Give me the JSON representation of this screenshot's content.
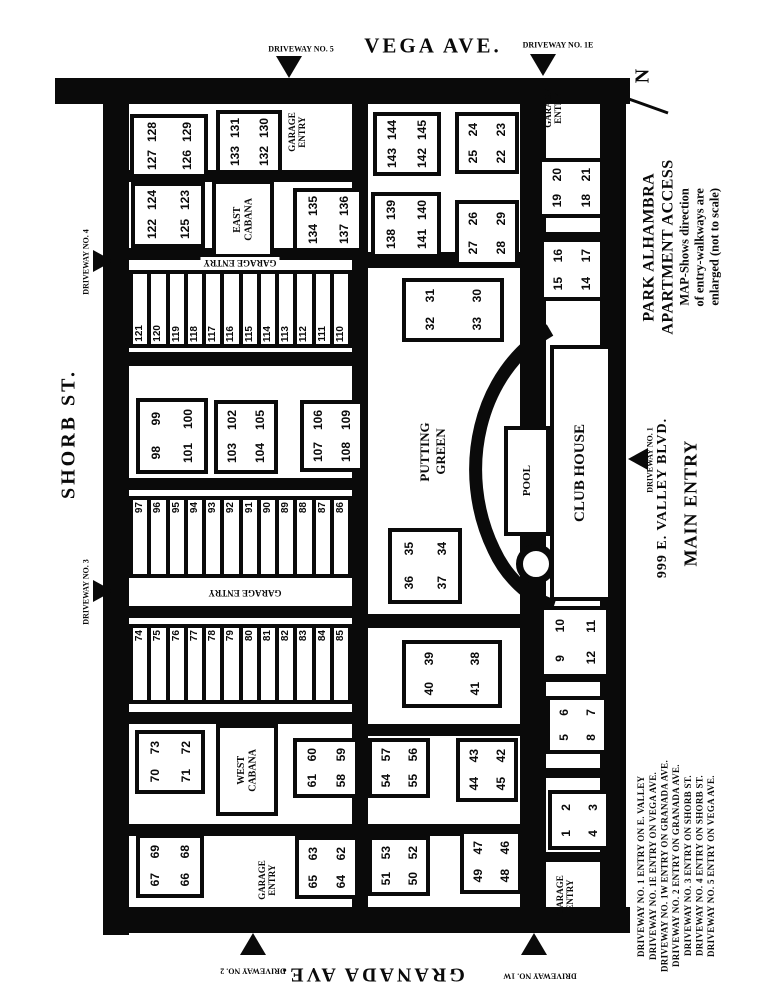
{
  "map": {
    "ink": "#0a0a0a",
    "bg": "#ffffff",
    "streets": {
      "top": "VEGA AVE.",
      "bottom": "GRANADA AVE.",
      "left": "SHORB ST.",
      "right_address": "999 E. VALLEY BLVD.",
      "right_entry": "MAIN ENTRY"
    },
    "north_label": "N",
    "title": {
      "line1": "PARK ALHAMBRA",
      "line2": "APARTMENT ACCESS",
      "line3": "MAP-Shows direction",
      "line4": "of entry-walkways are",
      "line5": "enlarged (not to scale)"
    },
    "legend": [
      "DRIVEWAY NO. 1 ENTRY ON E. VALLEY",
      "DRIVEWAY NO. 1E ENTRY ON VEGA AVE.",
      "DRIVEWAY NO. 1W ENTRY ON GRANADA AVE.",
      "DRIVEWAY NO. 2 ENTRY ON GRANADA AVE.",
      "DRIVEWAY NO. 3 ENTRY ON SHORB ST.",
      "DRIVEWAY NO. 4 ENTRY ON SHORB ST.",
      "DRIVEWAY NO. 5 ENTRY ON VEGA AVE."
    ],
    "roads": [
      {
        "id": "road-vega-top",
        "x": 55,
        "y": 78,
        "w": 575,
        "h": 26
      },
      {
        "id": "road-shorb-left",
        "x": 103,
        "y": 78,
        "w": 26,
        "h": 857
      },
      {
        "id": "road-granada-bottom",
        "x": 103,
        "y": 907,
        "w": 527,
        "h": 26
      },
      {
        "id": "road-valley-right",
        "x": 600,
        "y": 78,
        "w": 26,
        "h": 855
      },
      {
        "id": "road-center-west",
        "x": 352,
        "y": 96,
        "w": 16,
        "h": 812
      },
      {
        "id": "road-center-east",
        "x": 520,
        "y": 96,
        "w": 26,
        "h": 812
      },
      {
        "id": "walk-row1",
        "x": 129,
        "y": 170,
        "w": 223,
        "h": 12
      },
      {
        "id": "walk-aisle1",
        "x": 129,
        "y": 248,
        "w": 223,
        "h": 12
      },
      {
        "id": "walk-row2",
        "x": 129,
        "y": 352,
        "w": 223,
        "h": 14
      },
      {
        "id": "walk-row3",
        "x": 129,
        "y": 478,
        "w": 223,
        "h": 12
      },
      {
        "id": "walk-row4",
        "x": 129,
        "y": 606,
        "w": 223,
        "h": 12
      },
      {
        "id": "walk-row5",
        "x": 129,
        "y": 712,
        "w": 223,
        "h": 12
      },
      {
        "id": "walk-row6",
        "x": 129,
        "y": 824,
        "w": 223,
        "h": 12
      },
      {
        "id": "walk-mid1",
        "x": 368,
        "y": 252,
        "w": 152,
        "h": 16
      },
      {
        "id": "walk-mid2",
        "x": 368,
        "y": 614,
        "w": 152,
        "h": 14
      },
      {
        "id": "walk-mid3",
        "x": 368,
        "y": 724,
        "w": 152,
        "h": 12
      },
      {
        "id": "walk-mid4",
        "x": 368,
        "y": 824,
        "w": 152,
        "h": 12
      },
      {
        "id": "walk-east1",
        "x": 546,
        "y": 180,
        "w": 58,
        "h": 10
      },
      {
        "id": "walk-east2",
        "x": 546,
        "y": 232,
        "w": 58,
        "h": 12
      },
      {
        "id": "walk-east3",
        "x": 546,
        "y": 672,
        "w": 58,
        "h": 10
      },
      {
        "id": "walk-east4",
        "x": 546,
        "y": 768,
        "w": 58,
        "h": 10
      },
      {
        "id": "walk-east5",
        "x": 546,
        "y": 852,
        "w": 58,
        "h": 10
      }
    ],
    "buildings": [
      {
        "id": "building-126-129",
        "x": 130,
        "y": 114,
        "w": 70,
        "h": 56,
        "units": [
          [
            "128",
            "129"
          ],
          [
            "127",
            "126"
          ]
        ]
      },
      {
        "id": "building-130-133",
        "x": 216,
        "y": 110,
        "w": 58,
        "h": 56,
        "units": [
          [
            "131",
            "130"
          ],
          [
            "133",
            "132"
          ]
        ]
      },
      {
        "id": "building-122-125",
        "x": 131,
        "y": 182,
        "w": 66,
        "h": 58,
        "units": [
          [
            "124",
            "123"
          ],
          [
            "122",
            "125"
          ]
        ]
      },
      {
        "id": "building-134-137",
        "x": 293,
        "y": 188,
        "w": 62,
        "h": 56,
        "units": [
          [
            "135",
            "136"
          ],
          [
            "134",
            "137"
          ]
        ]
      },
      {
        "id": "building-142-145",
        "x": 373,
        "y": 112,
        "w": 60,
        "h": 56,
        "units": [
          [
            "144",
            "145"
          ],
          [
            "143",
            "142"
          ]
        ]
      },
      {
        "id": "building-22-25",
        "x": 455,
        "y": 112,
        "w": 56,
        "h": 54,
        "units": [
          [
            "24",
            "23"
          ],
          [
            "25",
            "22"
          ]
        ]
      },
      {
        "id": "building-138-141",
        "x": 371,
        "y": 192,
        "w": 62,
        "h": 58,
        "units": [
          [
            "139",
            "140"
          ],
          [
            "138",
            "141"
          ]
        ]
      },
      {
        "id": "building-26-29",
        "x": 455,
        "y": 200,
        "w": 56,
        "h": 58,
        "units": [
          [
            "26",
            "29"
          ],
          [
            "27",
            "28"
          ]
        ]
      },
      {
        "id": "building-18-21",
        "x": 538,
        "y": 158,
        "w": 58,
        "h": 52,
        "units": [
          [
            "20",
            "21"
          ],
          [
            "19",
            "18"
          ]
        ]
      },
      {
        "id": "building-14-17",
        "x": 540,
        "y": 238,
        "w": 56,
        "h": 55,
        "units": [
          [
            "16",
            "17"
          ],
          [
            "15",
            "14"
          ]
        ]
      },
      {
        "id": "building-30-33",
        "x": 402,
        "y": 278,
        "w": 94,
        "h": 56,
        "units": [
          [
            "31",
            "30"
          ],
          [
            "32",
            "33"
          ]
        ]
      },
      {
        "id": "building-98-101",
        "x": 136,
        "y": 398,
        "w": 64,
        "h": 68,
        "units": [
          [
            "99",
            "100"
          ],
          [
            "98",
            "101"
          ]
        ]
      },
      {
        "id": "building-102-105",
        "x": 214,
        "y": 400,
        "w": 56,
        "h": 66,
        "units": [
          [
            "102",
            "105"
          ],
          [
            "103",
            "104"
          ]
        ]
      },
      {
        "id": "building-106-109",
        "x": 300,
        "y": 400,
        "w": 56,
        "h": 64,
        "units": [
          [
            "106",
            "109"
          ],
          [
            "107",
            "108"
          ]
        ]
      },
      {
        "id": "building-34-37",
        "x": 388,
        "y": 528,
        "w": 66,
        "h": 68,
        "units": [
          [
            "35",
            "34"
          ],
          [
            "36",
            "37"
          ]
        ]
      },
      {
        "id": "building-38-41",
        "x": 402,
        "y": 640,
        "w": 92,
        "h": 60,
        "units": [
          [
            "39",
            "38"
          ],
          [
            "40",
            "41"
          ]
        ]
      },
      {
        "id": "building-9-12",
        "x": 540,
        "y": 606,
        "w": 62,
        "h": 64,
        "units": [
          [
            "10",
            "11"
          ],
          [
            "9",
            "12"
          ]
        ]
      },
      {
        "id": "building-70-73",
        "x": 135,
        "y": 730,
        "w": 62,
        "h": 56,
        "units": [
          [
            "73",
            "72"
          ],
          [
            "70",
            "71"
          ]
        ]
      },
      {
        "id": "building-58-61",
        "x": 293,
        "y": 738,
        "w": 58,
        "h": 52,
        "units": [
          [
            "60",
            "59"
          ],
          [
            "61",
            "58"
          ]
        ]
      },
      {
        "id": "building-54-57",
        "x": 368,
        "y": 738,
        "w": 54,
        "h": 52,
        "units": [
          [
            "57",
            "56"
          ],
          [
            "54",
            "55"
          ]
        ]
      },
      {
        "id": "building-42-45",
        "x": 456,
        "y": 738,
        "w": 54,
        "h": 56,
        "units": [
          [
            "43",
            "42"
          ],
          [
            "44",
            "45"
          ]
        ]
      },
      {
        "id": "building-5-8",
        "x": 546,
        "y": 696,
        "w": 54,
        "h": 50,
        "units": [
          [
            "6",
            "7"
          ],
          [
            "5",
            "8"
          ]
        ]
      },
      {
        "id": "building-66-69",
        "x": 136,
        "y": 834,
        "w": 60,
        "h": 56,
        "units": [
          [
            "69",
            "68"
          ],
          [
            "67",
            "66"
          ]
        ]
      },
      {
        "id": "building-62-65",
        "x": 295,
        "y": 836,
        "w": 56,
        "h": 55,
        "units": [
          [
            "63",
            "62"
          ],
          [
            "65",
            "64"
          ]
        ]
      },
      {
        "id": "building-50-53",
        "x": 368,
        "y": 836,
        "w": 54,
        "h": 52,
        "units": [
          [
            "53",
            "52"
          ],
          [
            "51",
            "50"
          ]
        ]
      },
      {
        "id": "building-46-49",
        "x": 460,
        "y": 830,
        "w": 54,
        "h": 56,
        "units": [
          [
            "47",
            "46"
          ],
          [
            "49",
            "48"
          ]
        ]
      },
      {
        "id": "building-1-4",
        "x": 548,
        "y": 790,
        "w": 54,
        "h": 52,
        "units": [
          [
            "2",
            "3"
          ],
          [
            "1",
            "4"
          ]
        ]
      }
    ],
    "garage_rows": [
      {
        "id": "garage-row-110-121",
        "x": 129,
        "y": 270,
        "w": 223,
        "h": 78,
        "numbers_at": "bottom",
        "units": [
          "121",
          "120",
          "119",
          "118",
          "117",
          "116",
          "115",
          "114",
          "113",
          "112",
          "111",
          "110"
        ]
      },
      {
        "id": "garage-row-86-97",
        "x": 129,
        "y": 496,
        "w": 223,
        "h": 82,
        "numbers_at": "top",
        "units": [
          "97",
          "96",
          "95",
          "94",
          "93",
          "92",
          "91",
          "90",
          "89",
          "88",
          "87",
          "86"
        ]
      },
      {
        "id": "garage-row-74-85",
        "x": 129,
        "y": 624,
        "w": 223,
        "h": 80,
        "numbers_at": "top",
        "units": [
          "74",
          "75",
          "76",
          "77",
          "78",
          "79",
          "80",
          "81",
          "82",
          "83",
          "84",
          "85"
        ]
      }
    ],
    "facilities": [
      {
        "id": "east-cabana",
        "x": 212,
        "y": 180,
        "w": 54,
        "h": 70,
        "font": 10,
        "lines": [
          "EAST",
          "CABANA"
        ]
      },
      {
        "id": "west-cabana",
        "x": 216,
        "y": 724,
        "w": 54,
        "h": 84,
        "font": 10,
        "lines": [
          "WEST",
          "CABANA"
        ]
      },
      {
        "id": "club-house",
        "x": 550,
        "y": 345,
        "w": 54,
        "h": 248,
        "font": 15,
        "lines": [
          "CLUB HOUSE"
        ]
      },
      {
        "id": "pool",
        "x": 504,
        "y": 426,
        "w": 38,
        "h": 102,
        "font": 11,
        "lines": [
          "POOL"
        ]
      }
    ],
    "area_labels": [
      {
        "id": "garage-entry-north",
        "x": 297,
        "y": 132,
        "rot": "side",
        "font": 9,
        "lines": [
          "GARAGE",
          "ENTRY"
        ]
      },
      {
        "id": "garage-entry-ne",
        "x": 553,
        "y": 108,
        "rot": "side",
        "font": 9,
        "lines": [
          "GARAGE",
          "ENTRY"
        ]
      },
      {
        "id": "garage-entry-aisle1",
        "x": 240,
        "y": 263,
        "rot": "flip",
        "font": 9,
        "whitebg": true,
        "lines": [
          "GARAGE ENTRY"
        ]
      },
      {
        "id": "garage-entry-aisle2",
        "x": 245,
        "y": 593,
        "rot": "flip",
        "font": 9,
        "whitebg": true,
        "lines": [
          "GARAGE ENTRY"
        ]
      },
      {
        "id": "garage-entry-sw",
        "x": 267,
        "y": 880,
        "rot": "side",
        "font": 9,
        "lines": [
          "GARAGE",
          "ENTRY"
        ]
      },
      {
        "id": "garage-entry-se",
        "x": 565,
        "y": 895,
        "rot": "side",
        "font": 9,
        "lines": [
          "GARAGE",
          "ENTRY"
        ]
      },
      {
        "id": "putting-green",
        "x": 433,
        "y": 452,
        "rot": "side",
        "font": 13,
        "lines": [
          "PUTTING",
          "GREEN"
        ]
      }
    ],
    "driveways": [
      {
        "id": "driveway-no-5",
        "label": "DRIVEWAY NO. 5",
        "dir": "down",
        "tx": 276,
        "ty": 56,
        "lx": 301,
        "ly": 49,
        "rot": "plain"
      },
      {
        "id": "driveway-no-1e",
        "label": "DRIVEWAY NO. 1E",
        "dir": "down",
        "tx": 530,
        "ty": 54,
        "lx": 558,
        "ly": 45,
        "rot": "plain"
      },
      {
        "id": "driveway-no-4",
        "label": "DRIVEWAY NO. 4",
        "dir": "right",
        "tx": 93,
        "ty": 250,
        "lx": 86,
        "ly": 262,
        "rot": "side"
      },
      {
        "id": "driveway-no-3",
        "label": "DRIVEWAY NO. 3",
        "dir": "right",
        "tx": 93,
        "ty": 580,
        "lx": 86,
        "ly": 592,
        "rot": "side"
      },
      {
        "id": "driveway-no-1",
        "label": "DRIVEWAY NO. 1",
        "dir": "left",
        "tx": 628,
        "ty": 448,
        "lx": 650,
        "ly": 460,
        "rot": "side"
      },
      {
        "id": "driveway-no-2",
        "label": "DRIVEWAY NO. 2",
        "dir": "up",
        "tx": 240,
        "ty": 933,
        "lx": 253,
        "ly": 971,
        "rot": "flip"
      },
      {
        "id": "driveway-no-1w",
        "label": "DRIVEWAY NO. 1W",
        "dir": "up",
        "tx": 521,
        "ty": 933,
        "lx": 540,
        "ly": 976,
        "rot": "flip"
      }
    ]
  }
}
